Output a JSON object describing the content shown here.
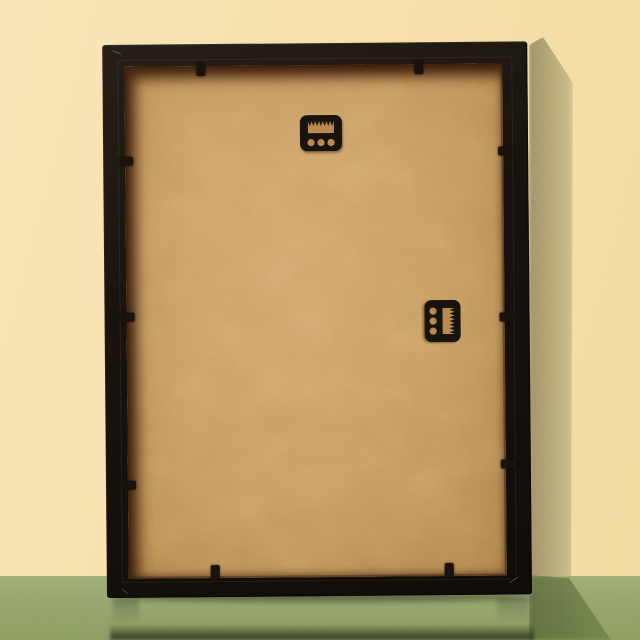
{
  "scene": {
    "type": "photograph",
    "description": "Back view of an empty black picture frame leaning against a pale yellow wall, standing on a glossy sage green surface with a soft cast shadow to the right and a dark reflection below",
    "objects": [
      {
        "name": "picture-frame-back",
        "description": "black wooden picture frame seen from behind"
      },
      {
        "name": "mdf-backing-board",
        "description": "tan MDF backing board recessed inside the frame"
      },
      {
        "name": "sawtooth-hanger-top",
        "description": "black sawtooth hanging bracket with three holes, horizontal, upper middle of backing"
      },
      {
        "name": "sawtooth-hanger-side",
        "description": "black sawtooth hanging bracket with three holes, rotated 90 degrees, middle right of backing"
      },
      {
        "name": "retainer-tabs",
        "description": "small black metal tabs holding the backing board",
        "count": 10
      },
      {
        "name": "wall",
        "description": "pale yellow wall"
      },
      {
        "name": "floor",
        "description": "sage green glossy surface"
      },
      {
        "name": "cast-shadow",
        "description": "soft olive shadow on wall and darker green shadow on floor, right of frame"
      },
      {
        "name": "reflection",
        "description": "dark blurred reflection of the frame at the bottom edge"
      }
    ],
    "colors": {
      "wall": "#f6e1ad",
      "wall_shadow": "#ac9d6e",
      "floor": "#97a66e",
      "floor_shadow": "#5f7338",
      "frame_black": "#17120d",
      "backing_tan": "#c6995f",
      "recess_brown": "#64381a",
      "hardware_black": "#18120c",
      "hole_tan": "#b8894f",
      "reflection": "#2c3220"
    }
  }
}
